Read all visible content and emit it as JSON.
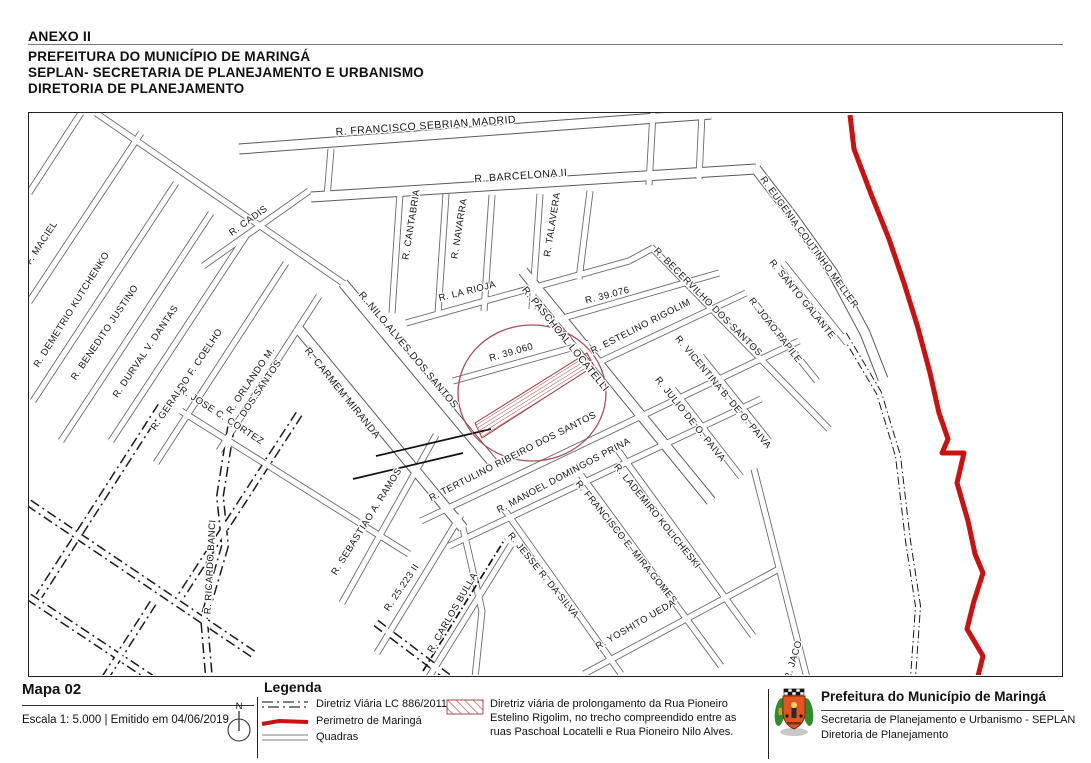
{
  "header": {
    "annex": "ANEXO II",
    "line1": "PREFEITURA DO MUNICÍPIO DE MARINGÁ",
    "line2": "SEPLAN- SECRETARIA DE PLANEJAMENTO E URBANISMO",
    "line3": "DIRETORIA DE PLANEJAMENTO"
  },
  "map": {
    "labels": [
      {
        "t": "R. FRANCISCO SEBRIAN MADRID",
        "x": 425,
        "y": 128,
        "a": -4,
        "s": 10.5
      },
      {
        "t": "R. BARCELONA II",
        "x": 520,
        "y": 178,
        "a": -4,
        "s": 10.5
      },
      {
        "t": "R. CANTABRIA",
        "x": 413,
        "y": 224,
        "a": -81
      },
      {
        "t": "R. NAVARRA",
        "x": 461,
        "y": 228,
        "a": -81
      },
      {
        "t": "R. TALAVERA",
        "x": 554,
        "y": 224,
        "a": -81
      },
      {
        "t": "R. LA RIOJA",
        "x": 467,
        "y": 293,
        "a": -14
      },
      {
        "t": "R. 39.076",
        "x": 607,
        "y": 297,
        "a": -14
      },
      {
        "t": "R. 39.060",
        "x": 511,
        "y": 354,
        "a": -16
      },
      {
        "t": "R. PASCHOAL  LOCATELLI",
        "x": 562,
        "y": 340,
        "a": 51,
        "s": 10
      },
      {
        "t": "R. ESTELINO RIGOLIM",
        "x": 641,
        "y": 328,
        "a": -27
      },
      {
        "t": "R. NILO ALVES DOS SANTOS",
        "x": 405,
        "y": 351,
        "a": 50,
        "s": 10
      },
      {
        "t": "R. CARMEM MIRANDA",
        "x": 339,
        "y": 394,
        "a": 51,
        "s": 10
      },
      {
        "t": "R. TERTULINO RIBEIRO DOS SANTOS",
        "x": 513,
        "y": 458,
        "a": -27
      },
      {
        "t": "R. MANOEL DOMINGOS PRINA",
        "x": 564,
        "y": 477,
        "a": -28
      },
      {
        "t": "R. LADEMIRO KOLICHESKI",
        "x": 654,
        "y": 517,
        "a": 51
      },
      {
        "t": "R. FRANCISCO E. MIRA GOMES",
        "x": 623,
        "y": 543,
        "a": 51
      },
      {
        "t": "R. JESSE R. DA SILVA",
        "x": 540,
        "y": 576,
        "a": 51
      },
      {
        "t": "R. YOSHITO UEDA",
        "x": 636,
        "y": 626,
        "a": -30
      },
      {
        "t": "R. SEBASTIAO A. RAMOS",
        "x": 368,
        "y": 522,
        "a": -58
      },
      {
        "t": "R. 25.223 II",
        "x": 403,
        "y": 588,
        "a": -56
      },
      {
        "t": "R. CARLOS BULLA",
        "x": 454,
        "y": 613,
        "a": -60
      },
      {
        "t": "R. RICARDO BANCI",
        "x": 212,
        "y": 566,
        "a": -87
      },
      {
        "t": "O F. MACIEL",
        "x": 40,
        "y": 248,
        "a": -57
      },
      {
        "t": "R. DEMETRIO KUTCHENKO",
        "x": 73,
        "y": 310,
        "a": -58
      },
      {
        "t": "R. BENEDITO JUSTINO",
        "x": 106,
        "y": 333,
        "a": -56
      },
      {
        "t": "R. DURVAL  V. DANTAS",
        "x": 147,
        "y": 352,
        "a": -56
      },
      {
        "t": "R. GERALDO F. COELHO",
        "x": 188,
        "y": 380,
        "a": -56
      },
      {
        "t": "R. JOSE C. CORTEZ",
        "x": 219,
        "y": 417,
        "a": 33
      },
      {
        "t": "R. ORLANDO M.",
        "t2": "DOS SANTOS",
        "x": 252,
        "y": 381,
        "a": -56
      },
      {
        "t": "R. CADIS",
        "x": 249,
        "y": 222,
        "a": -36
      },
      {
        "t": "R. EUGENIA COUTINHO MELLER",
        "x": 806,
        "y": 243,
        "a": 54
      },
      {
        "t": "R. BECERVILHO DOS SANTOS",
        "x": 705,
        "y": 303,
        "a": 45
      },
      {
        "t": "R. SANTO GALANTE",
        "x": 799,
        "y": 300,
        "a": 51
      },
      {
        "t": "R. JOAO PAPILE",
        "x": 772,
        "y": 331,
        "a": 52
      },
      {
        "t": "R. VICENTINA B. DE O. PAIVA",
        "x": 720,
        "y": 393,
        "a": 50
      },
      {
        "t": "R. JULIO DE O. PAIVA",
        "x": 687,
        "y": 420,
        "a": 51
      },
      {
        "t": "R. JACO",
        "x": 795,
        "y": 660,
        "a": -73
      }
    ]
  },
  "footer": {
    "map_number": "Mapa 02",
    "scale_line": "Escala 1: 5.000 | Emitido em 04/06/2019",
    "north": "N",
    "legend": {
      "title": "Legenda",
      "items": [
        {
          "symbol": "dash-dot-line",
          "label": "Diretriz Viária LC 886/2011"
        },
        {
          "symbol": "red-line",
          "label": "Perimetro de Maringá"
        },
        {
          "symbol": "double-gray-line",
          "label": "Quadras"
        }
      ],
      "hatch_note": "Diretriz viária de prolongamento da Rua Pioneiro Estelino Rigolim, no trecho compreendido entre as ruas Paschoal Locatelli e Rua Pioneiro Nilo Alves."
    },
    "org": {
      "logo": "maringa-coat-of-arms",
      "name": "Prefeitura do Município de Maringá",
      "dept1": "Secretaria de Planejamento e Urbanismo - SEPLAN",
      "dept2": "Diretoria de Planejamento"
    }
  },
  "colors": {
    "perimeter_red": "#cc1111",
    "diretriz_hatch_red": "#a33a3a",
    "highlight_circle_red": "#a85050",
    "road_casing": "#5a5a5a",
    "diretriz_black": "#1a1a1a"
  }
}
